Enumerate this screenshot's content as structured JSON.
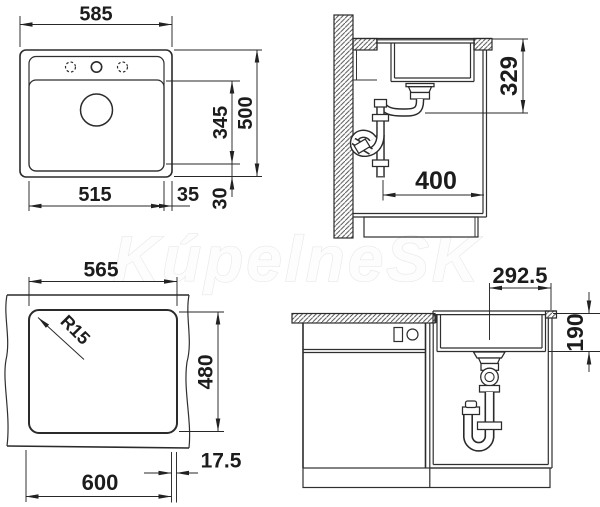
{
  "watermark": "KúpelneSK",
  "colors": {
    "line": "#2b2b2b",
    "dimension_text": "#1c1c1c",
    "watermark_stroke": "#e8e8e8"
  },
  "views": {
    "plan": {
      "overall_width": "585",
      "overall_depth": "500",
      "bowl_width": "515",
      "bowl_depth": "345",
      "edge_gap_right": "35",
      "edge_gap_bottom": "30"
    },
    "side_section": {
      "drain_height": "329",
      "drain_offset": "400"
    },
    "cutout": {
      "cutout_width": "565",
      "cutout_depth": "480",
      "corner_radius": "R15",
      "cabinet_width": "600",
      "edge_offset": "17.5"
    },
    "front": {
      "drain_center_offset": "292.5",
      "clearance_below": "190"
    }
  }
}
